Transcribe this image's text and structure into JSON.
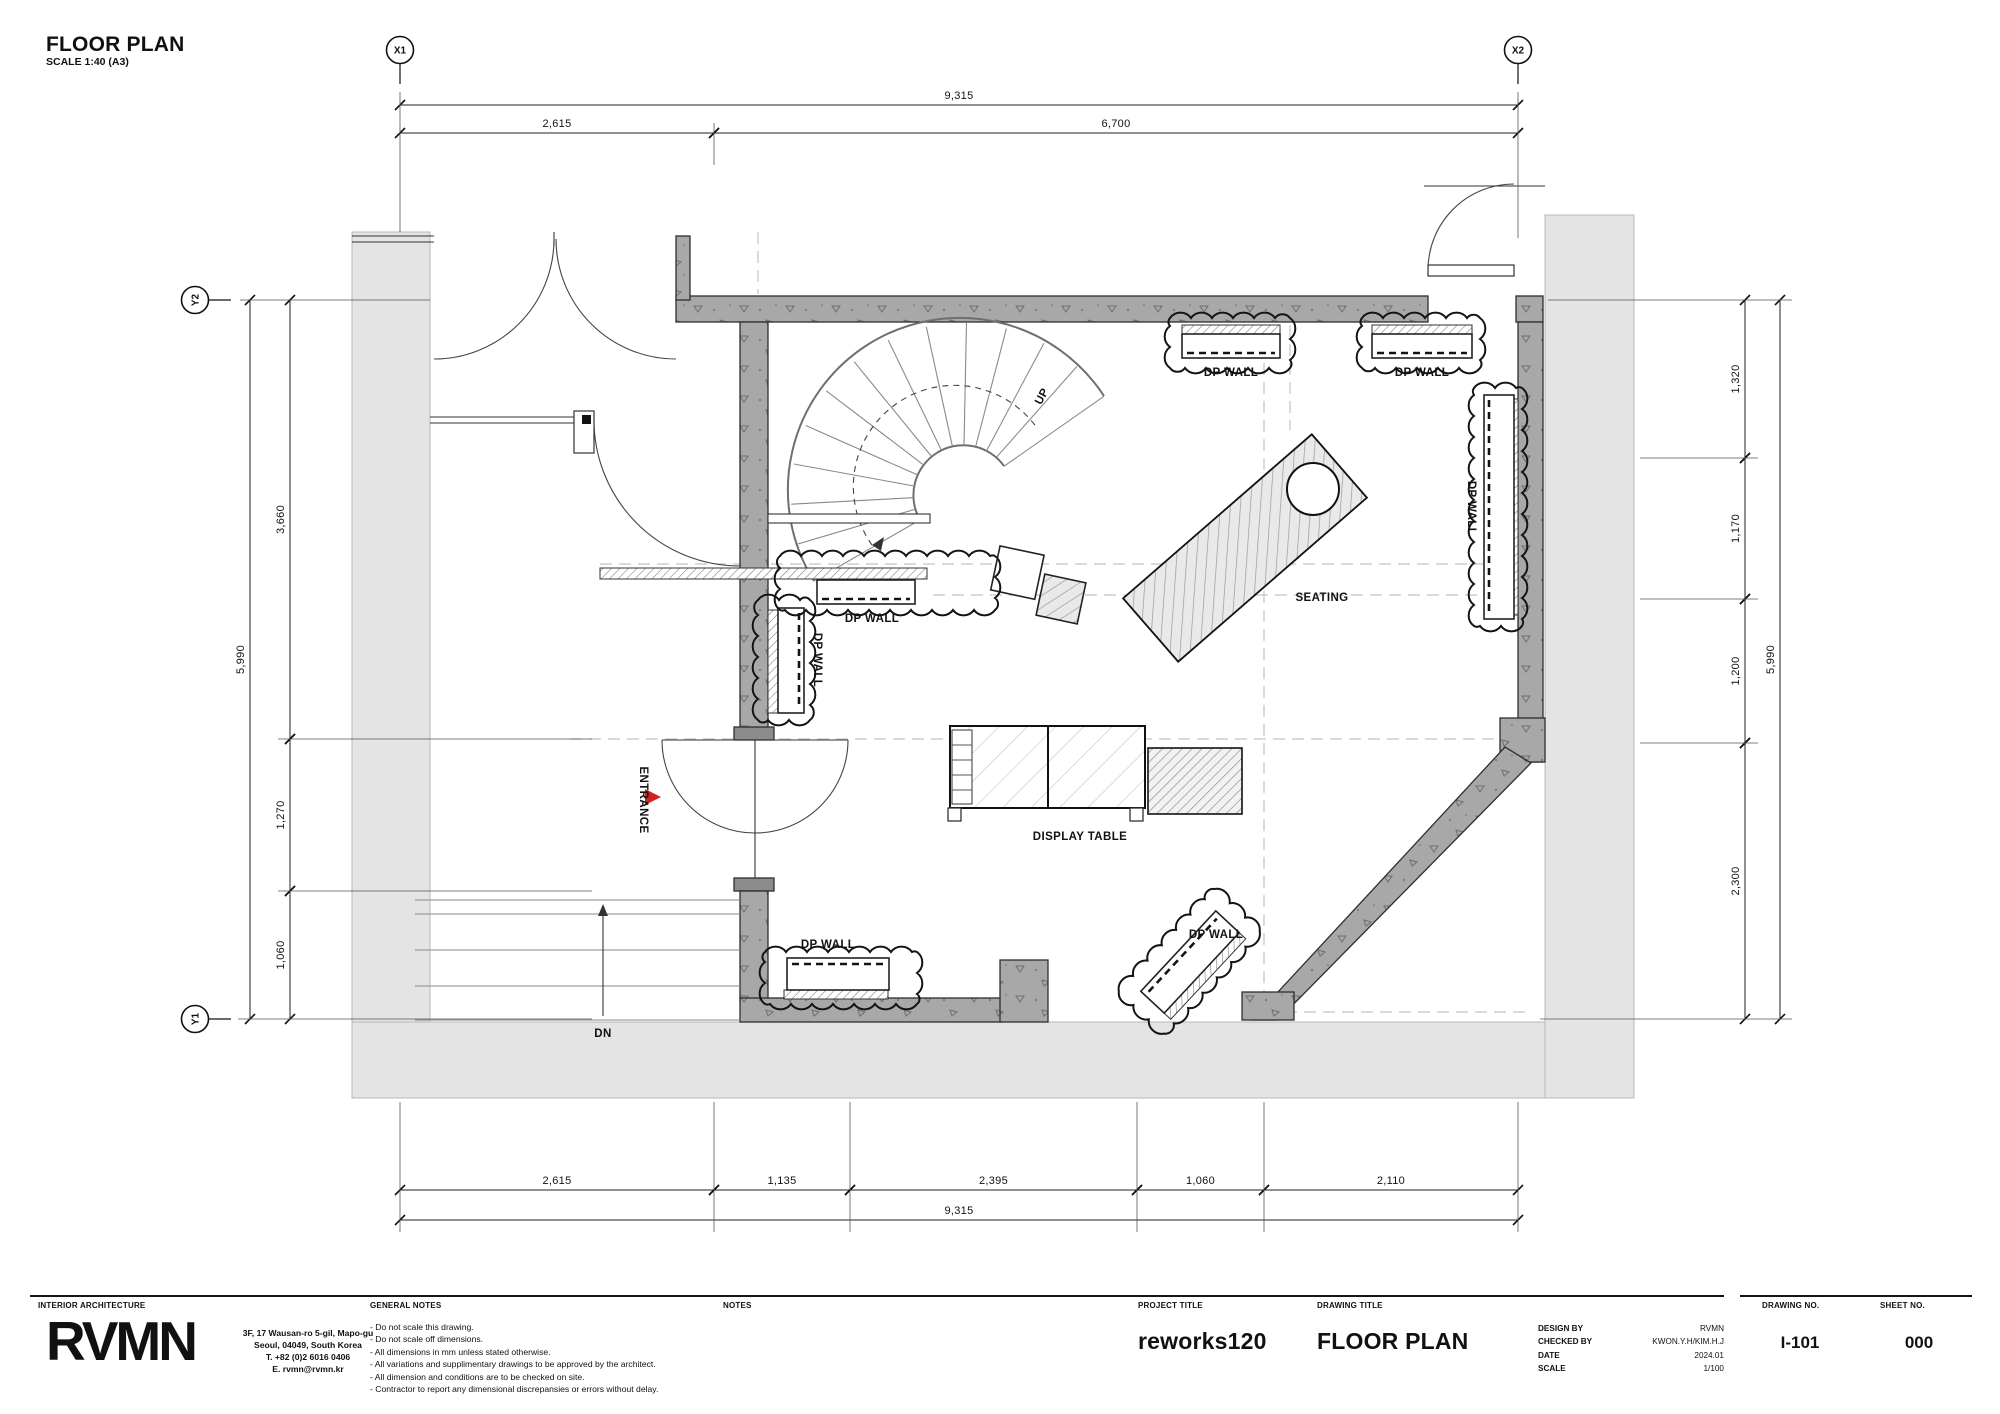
{
  "sheet_header": {
    "title": "FLOOR PLAN",
    "scale_note": "SCALE 1:40 (A3)"
  },
  "grid_markers": [
    {
      "label": "X1",
      "x": 400,
      "y": 50,
      "stem": "v"
    },
    {
      "label": "X2",
      "x": 1518,
      "y": 50,
      "stem": "v"
    },
    {
      "label": "Y2",
      "x": 195,
      "y": 300,
      "stem": "h"
    },
    {
      "label": "Y1",
      "x": 195,
      "y": 1019,
      "stem": "h"
    }
  ],
  "dimensions": {
    "top": {
      "overall": "9,315",
      "segments": [
        "2,615",
        "6,700"
      ]
    },
    "bottom": {
      "overall": "9,315",
      "segments": [
        "2,615",
        "1,135",
        "2,395",
        "1,060",
        "2,110"
      ]
    },
    "left": {
      "overall": "5,990",
      "segments": [
        "3,660",
        "1,270",
        "1,060"
      ]
    },
    "right": {
      "overall": "5,990",
      "segments": [
        "1,320",
        "1,170",
        "1,200",
        "2,300"
      ]
    }
  },
  "dim_chains": [
    {
      "o": "h",
      "pos": 105,
      "segs": [
        [
          400,
          1518,
          "9,315"
        ]
      ]
    },
    {
      "o": "h",
      "pos": 133,
      "segs": [
        [
          400,
          714,
          "2,615"
        ],
        [
          714,
          1518,
          "6,700"
        ]
      ]
    },
    {
      "o": "h",
      "pos": 1190,
      "segs": [
        [
          400,
          714,
          "2,615"
        ],
        [
          714,
          850,
          "1,135"
        ],
        [
          850,
          1137,
          "2,395"
        ],
        [
          1137,
          1264,
          "1,060"
        ],
        [
          1264,
          1518,
          "2,110"
        ]
      ]
    },
    {
      "o": "h",
      "pos": 1220,
      "segs": [
        [
          400,
          1518,
          "9,315"
        ]
      ]
    },
    {
      "o": "v",
      "pos": 250,
      "segs": [
        [
          300,
          1019,
          "5,990"
        ]
      ]
    },
    {
      "o": "v",
      "pos": 290,
      "segs": [
        [
          300,
          739,
          "3,660"
        ],
        [
          739,
          891,
          "1,270"
        ],
        [
          891,
          1019,
          "1,060"
        ]
      ]
    },
    {
      "o": "v",
      "pos": 1745,
      "segs": [
        [
          300,
          458,
          "1,320"
        ],
        [
          458,
          599,
          "1,170"
        ],
        [
          599,
          743,
          "1,200"
        ],
        [
          743,
          1019,
          "2,300"
        ]
      ]
    },
    {
      "o": "v",
      "pos": 1780,
      "segs": [
        [
          300,
          1019,
          "5,990"
        ]
      ]
    }
  ],
  "ext_lines": [
    [
      400,
      92,
      400,
      232
    ],
    [
      1518,
      92,
      1518,
      238
    ],
    [
      714,
      123,
      714,
      165
    ],
    [
      400,
      1102,
      400,
      1232
    ],
    [
      714,
      1102,
      714,
      1232
    ],
    [
      850,
      1102,
      850,
      1232
    ],
    [
      1137,
      1102,
      1137,
      1232
    ],
    [
      1264,
      1102,
      1264,
      1232
    ],
    [
      1518,
      1102,
      1518,
      1232
    ],
    [
      240,
      300,
      430,
      300
    ],
    [
      278,
      739,
      592,
      739
    ],
    [
      278,
      891,
      592,
      891
    ],
    [
      238,
      1019,
      592,
      1019
    ],
    [
      1548,
      300,
      1792,
      300
    ],
    [
      1640,
      458,
      1758,
      458
    ],
    [
      1640,
      599,
      1758,
      599
    ],
    [
      1640,
      743,
      1758,
      743
    ],
    [
      1540,
      1019,
      1792,
      1019
    ]
  ],
  "plan_labels": [
    {
      "id": "dp-wall-top-1",
      "text": "DP WALL",
      "x": 1231,
      "y": 376
    },
    {
      "id": "dp-wall-top-2",
      "text": "DP WALL",
      "x": 1422,
      "y": 376
    },
    {
      "id": "dp-wall-right",
      "text": "DP WALL",
      "x": 1468,
      "y": 508,
      "rot": 90
    },
    {
      "id": "dp-wall-mid-h",
      "text": "DP WALL",
      "x": 872,
      "y": 622
    },
    {
      "id": "dp-wall-mid-v",
      "text": "DP WALL",
      "x": 814,
      "y": 660,
      "rot": 90
    },
    {
      "id": "dp-wall-bottom-left",
      "text": "DP WALL",
      "x": 828,
      "y": 948
    },
    {
      "id": "dp-wall-bottom-right",
      "text": "DP WALL",
      "x": 1216,
      "y": 938
    },
    {
      "id": "seating",
      "text": "SEATING",
      "x": 1322,
      "y": 601
    },
    {
      "id": "display-table",
      "text": "DISPLAY TABLE",
      "x": 1080,
      "y": 840
    },
    {
      "id": "entrance",
      "text": "ENTRANCE",
      "x": 640,
      "y": 800,
      "rot": 90
    },
    {
      "id": "up",
      "text": "UP",
      "x": 1045,
      "y": 398,
      "rot": -62
    },
    {
      "id": "dn",
      "text": "DN",
      "x": 603,
      "y": 1037
    }
  ],
  "clouds": [
    {
      "x": 1170,
      "y": 318,
      "w": 120,
      "h": 50
    },
    {
      "x": 1362,
      "y": 318,
      "w": 118,
      "h": 50
    },
    {
      "x": 1474,
      "y": 388,
      "w": 48,
      "h": 238
    },
    {
      "x": 780,
      "y": 556,
      "w": 215,
      "h": 54
    },
    {
      "x": 758,
      "y": 600,
      "w": 52,
      "h": 120
    },
    {
      "x": 765,
      "y": 952,
      "w": 152,
      "h": 52
    },
    {
      "x": 1120,
      "y": 930,
      "w": 140,
      "h": 62,
      "rot": -47,
      "px": 1190,
      "py": 962
    }
  ],
  "title_block": {
    "discipline": "INTERIOR ARCHITECTURE",
    "logo": "RVMN",
    "address_lines": [
      "3F, 17 Wausan-ro 5-gil, Mapo-gu",
      "Seoul, 04049, South Korea",
      "T. +82 (0)2 6016 0406",
      "E.        rvmn@rvmn.kr"
    ],
    "general_notes_header": "GENERAL NOTES",
    "general_notes": [
      "- Do not scale this drawing.",
      "- Do not scale off dimensions.",
      "- All dimensions in mm unless stated otherwise.",
      "- All variations and supplimentary drawings to be  approved by the architect.",
      "- All dimension and conditions are to be checked on site.",
      "- Contractor to report any dimensional discrepansies  or  errors  without delay."
    ],
    "notes_header": "NOTES",
    "project_title_header": "PROJECT TITLE",
    "project_title": "reworks120",
    "drawing_title_header": "DRAWING TITLE",
    "drawing_title": "FLOOR PLAN",
    "meta": [
      [
        "DESIGN BY",
        "RVMN"
      ],
      [
        "CHECKED BY",
        "KWON.Y.H/KIM.H.J"
      ],
      [
        "DATE",
        "2024.01"
      ],
      [
        "SCALE",
        "1/100"
      ]
    ],
    "drawing_no_header": "DRAWING NO.",
    "drawing_no": "I-101",
    "sheet_no_header": "SHEET NO.",
    "sheet_no": "000"
  },
  "colors": {
    "wall_fill": "#a8a8a8",
    "context_fill": "#e4e4e4",
    "entrance_arrow": "#d42020",
    "line": "#111111"
  }
}
